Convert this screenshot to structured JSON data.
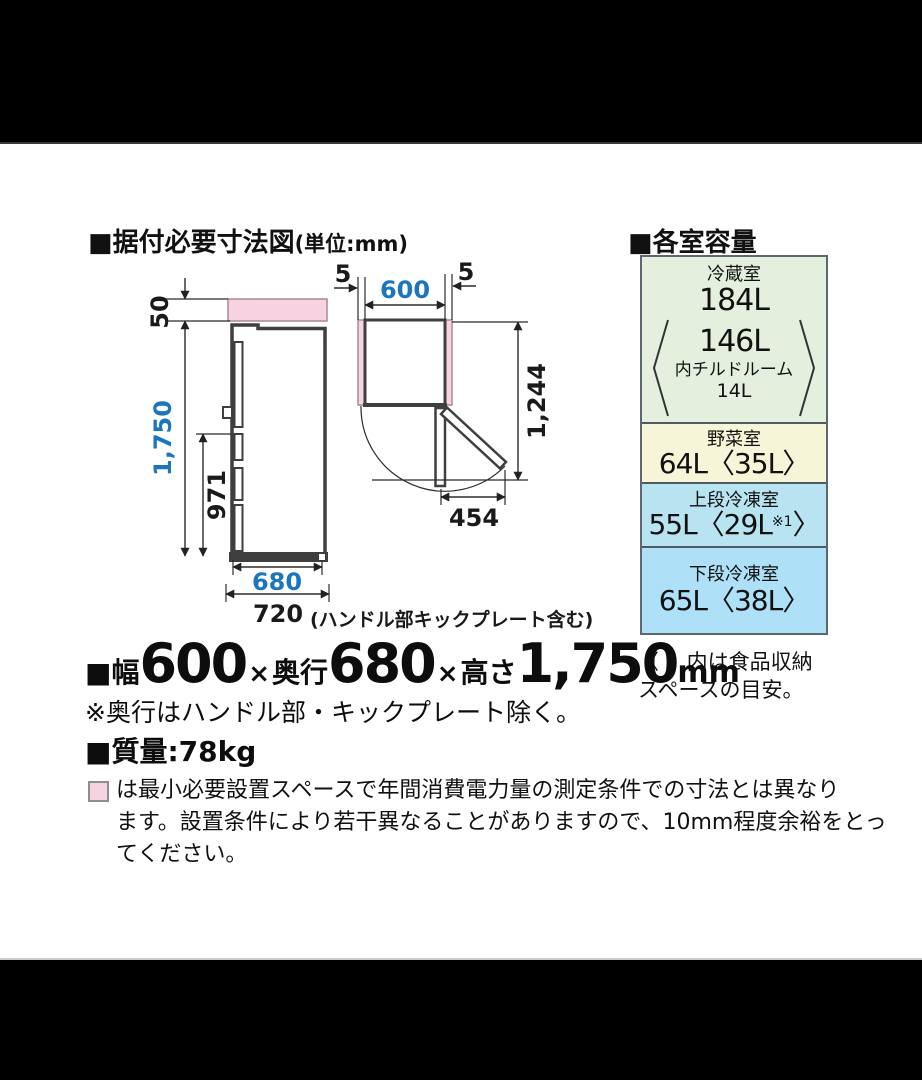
{
  "headings": {
    "install_title": "■据付必要寸法図",
    "install_unit": "(単位:mm)",
    "capacity_title": "■各室容量"
  },
  "dimensions": {
    "top_clearance": "50",
    "height": "1,750",
    "handle_height": "971",
    "depth_body": "680",
    "depth_total": "720",
    "depth_total_note": "(ハンドル部キックプレート含む)",
    "side_clearance_left": "5",
    "width": "600",
    "side_clearance_right": "5",
    "open_depth": "1,244",
    "door_swing": "454"
  },
  "spec": {
    "width_prefix": "■幅",
    "width": "600",
    "times": "×",
    "depth_label": "奥行",
    "depth": "680",
    "height_label": "高さ",
    "height": "1,750",
    "unit": "mm"
  },
  "notes": {
    "depth_note": "※奥行はハンドル部・キックプレート除く。",
    "weight": "■質量:78kg",
    "legend_line1": "は最小必要設置スペースで年間消費電力量の測定条件での寸法とは異なり",
    "legend_line2": "ます。設置条件により若干異なることがありますので、10mm程度余裕をとっ",
    "legend_line3": "てください。"
  },
  "capacity": {
    "sections": [
      {
        "name": "冷蔵室",
        "value": "184L",
        "inner_value": "146L",
        "inner_label": "内チルドルーム",
        "inner_sub": "14L",
        "color": "#e4efdd"
      },
      {
        "name": "野菜室",
        "value": "64L〈35L〉",
        "color": "#f6f5d8"
      },
      {
        "name": "上段冷凍室",
        "value_main": "55L〈29L",
        "value_sup": "※1",
        "value_close": "〉",
        "color": "#b8e3f1"
      },
      {
        "name": "下段冷凍室",
        "value": "65L〈38L〉",
        "color": "#aee0f8"
      }
    ],
    "note_line1": "〈 〉内は食品収納",
    "note_line2": "スペースの目安。"
  },
  "colors": {
    "dim_blue": "#1b76bd",
    "min_space_pink": "#f7d3e1",
    "outline_gray": "#3f3f3f"
  }
}
